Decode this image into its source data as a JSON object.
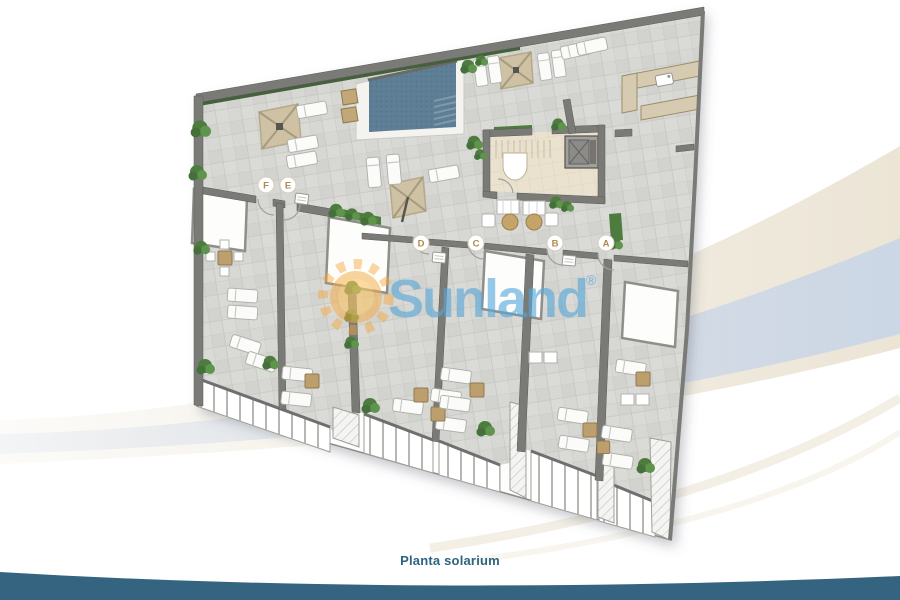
{
  "caption": "Planta solarium",
  "watermark": {
    "brand": "Sunland",
    "registered_mark": "®"
  },
  "plan": {
    "unit_labels": [
      {
        "id": "unit-f",
        "text": "F"
      },
      {
        "id": "unit-e",
        "text": "E"
      },
      {
        "id": "unit-d",
        "text": "D"
      },
      {
        "id": "unit-c",
        "text": "C"
      },
      {
        "id": "unit-b",
        "text": "B"
      },
      {
        "id": "unit-a",
        "text": "A"
      }
    ]
  },
  "colors": {
    "caption_text": "#2d6480",
    "bottom_wave": "#356480",
    "swoosh_beige": "#ece5d6",
    "swoosh_blue": "#ccd7e6",
    "watermark_blue": "#57a8da",
    "sun_orange": "#f4a73c",
    "pool_water": "#5d7e94",
    "pergola_tan": "#cfc2a4",
    "hedge_green": "#43613a",
    "bush_green": "#4d7c3e",
    "floor_tile": "#d7d7d4",
    "wall_gray": "#7a7a77",
    "unit_label_letter": "#b08a50",
    "lounger_white": "#fbfbf9",
    "table_tan": "#bd9f6d"
  }
}
